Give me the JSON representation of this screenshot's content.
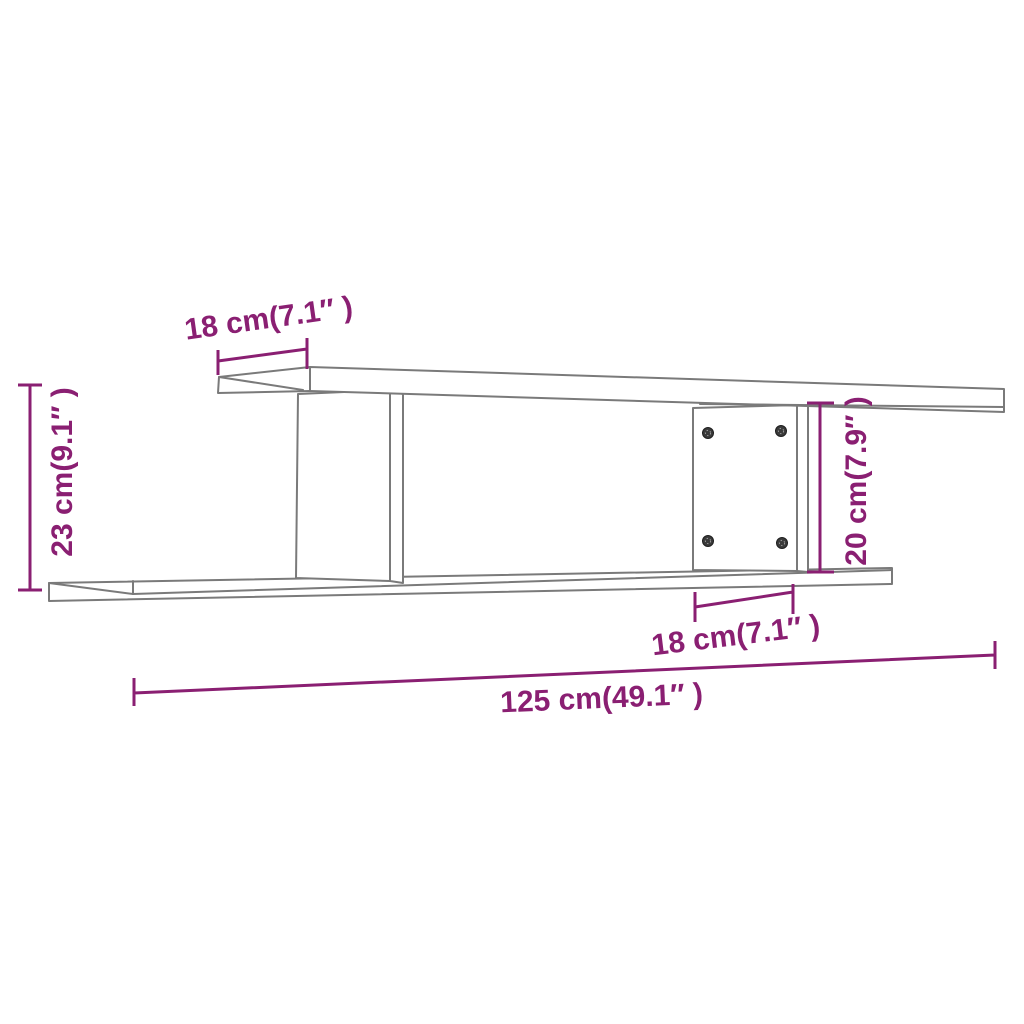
{
  "diagram": {
    "kind": "product-dimension-diagram",
    "subject": "wall-mounted-shelf",
    "background_color": "#ffffff",
    "outline_color": "#7a7a7a",
    "dimension_color": "#8A1F72",
    "labels": {
      "top_shelf_depth": "18 cm(7.1″ )",
      "overall_height": "23 cm(9.1″ )",
      "right_panel_height": "20 cm(7.9″ )",
      "bottom_shelf_depth": "18 cm(7.1″ )",
      "overall_width": "125 cm(49.1″ )"
    },
    "measurements": {
      "top_shelf_depth_cm": 18,
      "overall_height_cm": 23,
      "right_panel_height_cm": 20,
      "bottom_shelf_depth_cm": 18,
      "overall_width_cm": 125
    },
    "screw_count": 4
  }
}
